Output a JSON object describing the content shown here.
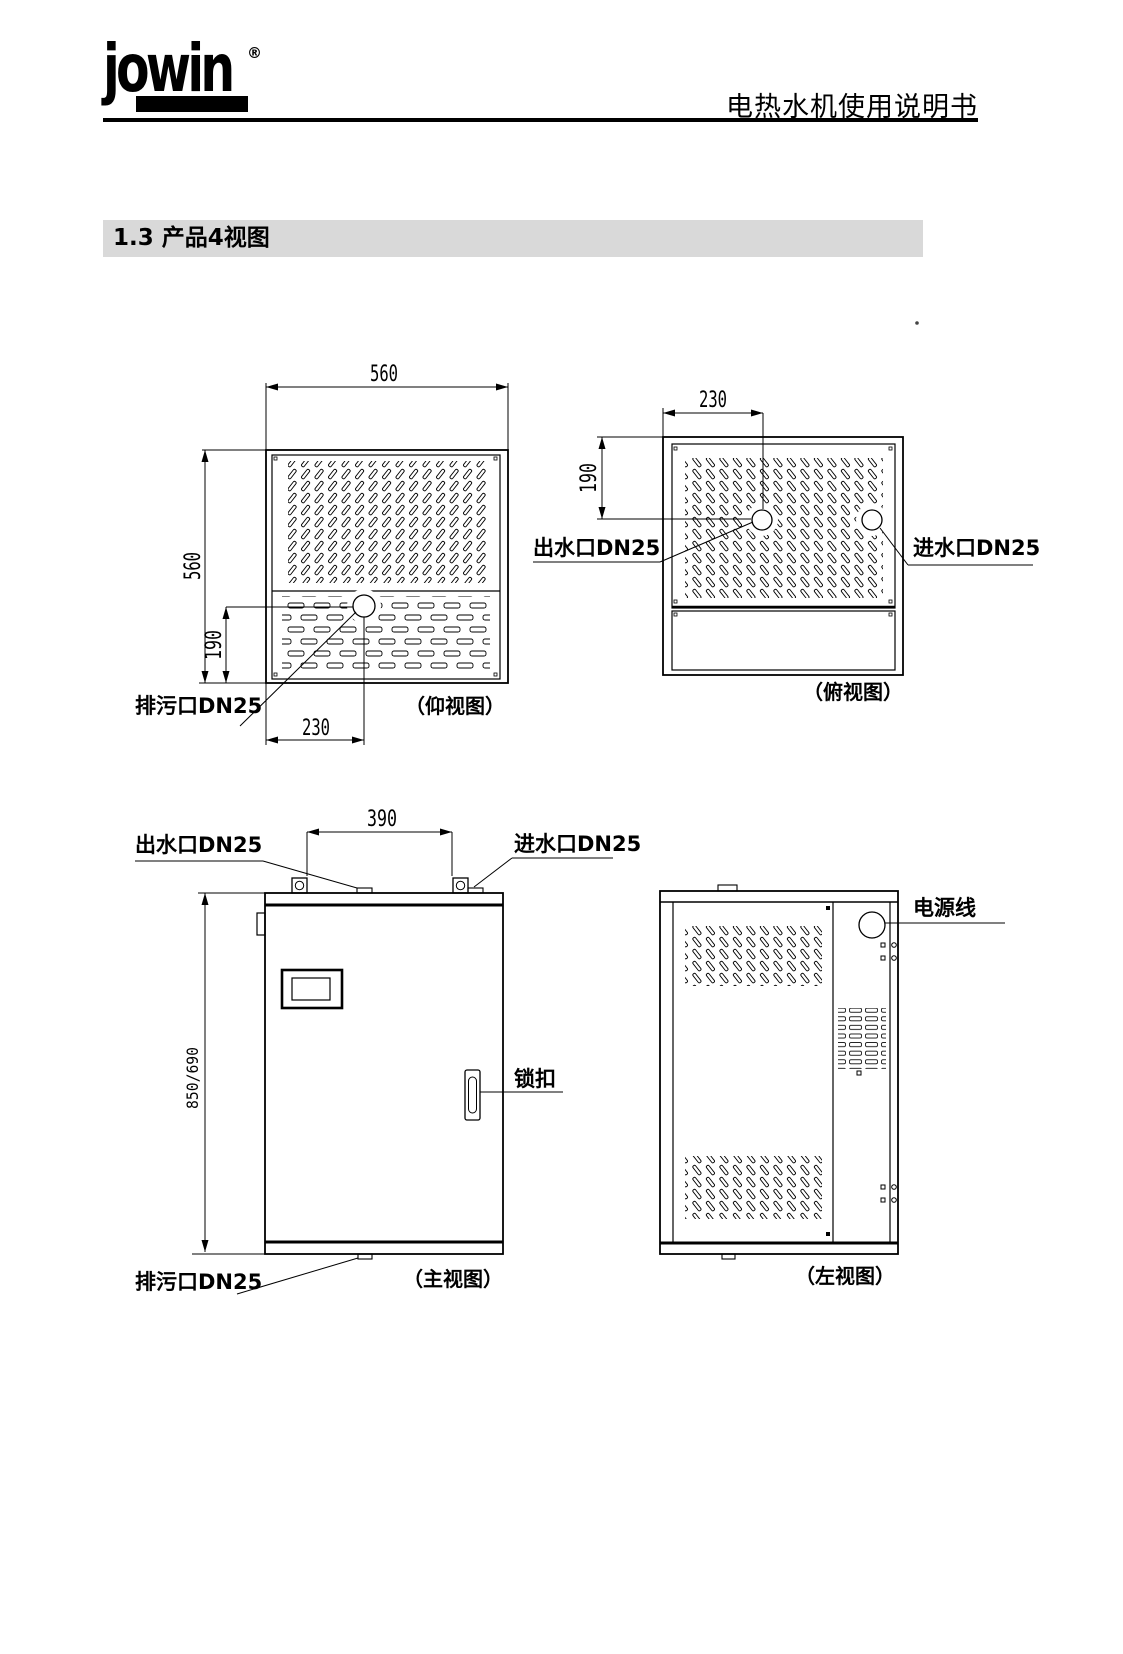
{
  "header": {
    "brand": "jowin",
    "trademark": "®",
    "doc_title": "电热水机使用说明书"
  },
  "section": {
    "heading": "1.3 产品4视图"
  },
  "views": {
    "bottom_view": {
      "caption": "（仰视图）",
      "dim_width": "560",
      "dim_height": "560",
      "dim_drain_offset_y": "190",
      "dim_drain_offset_x": "230",
      "label_drain": "排污口DN25"
    },
    "top_view": {
      "caption": "（俯视图）",
      "dim_outlet_offset_x": "230",
      "dim_outlet_offset_y": "190",
      "label_outlet": "出水口DN25",
      "label_inlet": "进水口DN25"
    },
    "front_view": {
      "caption": "（主视图）",
      "dim_port_spacing": "390",
      "dim_height": "850/690",
      "label_outlet": "出水口DN25",
      "label_inlet": "进水口DN25",
      "label_latch": "锁扣",
      "label_drain": "排污口DN25"
    },
    "left_view": {
      "caption": "（左视图）",
      "label_power_cord": "电源线"
    }
  }
}
